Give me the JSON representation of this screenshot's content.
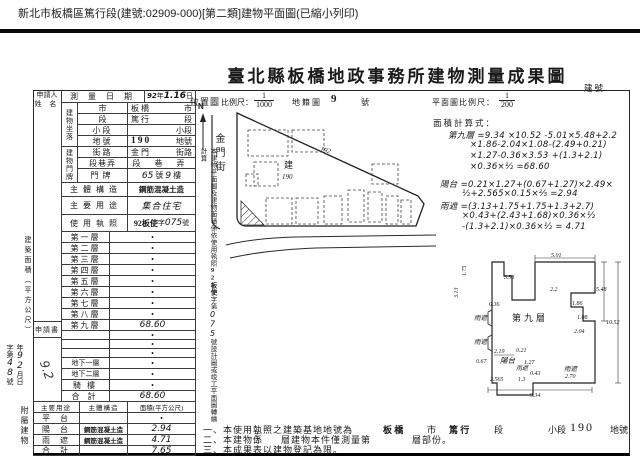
{
  "print_header": {
    "title": "新北市板橋區篤行段(建號:02909-000)[第二類]建物平面圖(已縮小列印)"
  },
  "doc": {
    "title": "臺北縣板橋地政事務所建物測量成果圖",
    "building_no_label": "建號"
  },
  "applicant": {
    "line1": "申請人",
    "line2": "姓 名"
  },
  "survey": {
    "label": "測量日期",
    "y": "92",
    "y_s": "年",
    "d": "1.16",
    "d_s": "日"
  },
  "location": {
    "group": "建物坐落",
    "rows": [
      {
        "label": "市",
        "value": "板 橋",
        "suffix": "市"
      },
      {
        "label": "段",
        "value": "篤 行",
        "suffix": "段"
      },
      {
        "label": "小段",
        "value": "",
        "suffix": "小段"
      },
      {
        "label": "地號",
        "value": "190",
        "suffix": "地號"
      }
    ]
  },
  "door": {
    "group": "建物門牌",
    "street": {
      "label": "街路",
      "value": "金 門",
      "suffix": "街路"
    },
    "lane": {
      "label": "段巷弄",
      "suffix": "段 巷 弄"
    },
    "no": {
      "label": "門牌",
      "h1": "65",
      "s1": "號",
      "h2": "9",
      "s2": "樓"
    }
  },
  "structure": {
    "label": "主體構造",
    "value": "鋼筋混凝土造"
  },
  "usage": {
    "label": "主要用途",
    "value": "集合住宅"
  },
  "license": {
    "label": "使用執照",
    "stamp": "92板使",
    "mid": "字",
    "hand": "075",
    "suffix": "號"
  },
  "area": {
    "side_label": "建築面積（平方公尺）",
    "floors": [
      {
        "label": "第一層",
        "value": "•"
      },
      {
        "label": "第二層",
        "value": "•"
      },
      {
        "label": "第三層",
        "value": "•"
      },
      {
        "label": "第四層",
        "value": "•"
      },
      {
        "label": "第五層",
        "value": "•"
      },
      {
        "label": "第六層",
        "value": "•"
      },
      {
        "label": "第七層",
        "value": "•"
      },
      {
        "label": "第八層",
        "value": "•"
      },
      {
        "label": "第九層",
        "value": "68.60"
      },
      {
        "label": "",
        "value": "•"
      },
      {
        "label": "",
        "value": "•"
      },
      {
        "label": "",
        "value": "•"
      },
      {
        "label": "地下一層",
        "value": "•"
      },
      {
        "label": "地下二層",
        "value": "•"
      },
      {
        "label": "騎樓",
        "value": "•"
      },
      {
        "label": "合計",
        "value": "68.60"
      }
    ]
  },
  "application": {
    "label": "申請書",
    "no_pre": "字第",
    "no_hand": "48",
    "no_suf": "號",
    "d1": "年",
    "d1h": "92",
    "d2": "月",
    "d3": "日",
    "stamp_hand": "9.2"
  },
  "annex": {
    "side_label": "附屬建物",
    "headers": [
      "主要用途",
      "主體構造",
      "面積(平方公尺)"
    ],
    "rows": [
      {
        "use": "平 台",
        "structure": "",
        "area": "•"
      },
      {
        "use": "陽 台",
        "structure": "鋼筋混凝土造",
        "area": "2.94"
      },
      {
        "use": "雨 遮",
        "structure": "鋼筋混凝土造",
        "area": "4.71"
      },
      {
        "use": "合 計",
        "structure": "",
        "area": "7.65"
      }
    ]
  },
  "side_note": {
    "pre": "本建物平面圖及建物面積係依使用執照",
    "stamp": "92板使",
    "mid": "字第",
    "hand": "075",
    "post": "號設計圖或竣工平面圖轉繪計算"
  },
  "map": {
    "label": "位置圖",
    "scale_label": "比例尺：",
    "num": "1",
    "den": "1000",
    "sheet_type": "地籍圖",
    "sheet_no": "9",
    "sheet_suffix": "號",
    "north": "N",
    "street": "金門街",
    "parcel_prefix": "建",
    "parcel_no": "190",
    "adjacent_no": "192"
  },
  "plan": {
    "scale_label": "平面圖比例尺：",
    "num": "1",
    "den": "200",
    "calc_label": "面積計算式：",
    "calc_lines": [
      "第九層 =9.34 ×10.52 -5.01×5.48+2.2",
      "×1.86-2.04×1.08-(2.49+0.21)",
      "×1.27-0.36×3.53 +(1.3+2.1)",
      "×0.36×½ =68.60",
      "陽台 =0.21×1.27+(0.67+1.27)×2.49×",
      "½+2.565×0.15×⅔ =2.94",
      "雨遮 =(3.13+1.75+1.75+1.3+2.7)",
      "×0.43+(2.43+1.68)×0.36×½",
      "-(1.3+2.1)×0.36×½ = 4.71"
    ],
    "floor_label": "第九層",
    "canopy": "雨遮",
    "balcony": "陽台",
    "dims": {
      "top": "5.01",
      "right": "5.48",
      "total": "10.52",
      "s1": "2.2",
      "s2": "1.86",
      "s3": "1.08",
      "s4": "2.04",
      "bottom": "9.34",
      "v1": "3.53",
      "v2": "0.36",
      "b1": "2.19",
      "b2": "0.21",
      "b3": "0.67",
      "b4": "1.27",
      "b5": "2.565",
      "b6": "1.3",
      "b7": "0.43",
      "b8": "2.70",
      "l1": "3.13",
      "l2": "1.75"
    }
  },
  "notes": {
    "n1_pre": "一、本使用執照之建築基地地號為",
    "n1_city": "板 橋",
    "n1_city_s": "市",
    "n1_sec": "篤 行",
    "n1_sec_s": "段",
    "n1_sub": "小段",
    "n1_no": "190",
    "n1_no_s": "地號",
    "n2_pre": "二、本建物係",
    "n2_hand": "十二",
    "n2_mid": "層建物本件僅測量第",
    "n2_post": "層部份。",
    "n3": "三、本成果表以建物登記為限。"
  }
}
